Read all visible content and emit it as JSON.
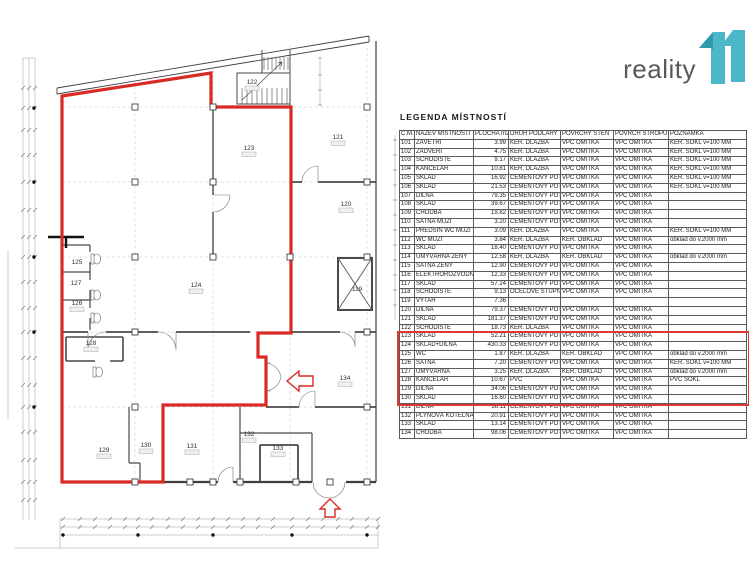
{
  "logo": {
    "text": "reality",
    "mark": "11",
    "teal": "#4bb7c8",
    "teal_dark": "#2e9aac",
    "text_color": "#58595b"
  },
  "legend": {
    "title": "LEGENDA MÍSTNOSTÍ",
    "columns": [
      "Č.M.",
      "NÁZEV MÍSTNOSTI",
      "PLOCHA m2",
      "DRUH PODLAHY",
      "POVRCHY STĚN",
      "POVRCH STROPU",
      "POZNÁMKA"
    ],
    "rows": [
      [
        "101",
        "ZÁVĚTŘÍ",
        "3.99",
        "KER. DLAŽBA",
        "VPC OMÍTKA",
        "VPC OMÍTKA",
        "KER. SOKL v=100 MM"
      ],
      [
        "102",
        "ZÁDVEŘÍ",
        "4.75",
        "KER. DLAŽBA",
        "VPC OMÍTKA",
        "VPC OMÍTKA",
        "KER. SOKL v=100 MM"
      ],
      [
        "103",
        "SCHODIŠTĚ",
        "9.17",
        "KER. DLAŽBA",
        "VPC OMÍTKA",
        "VPC OMÍTKA",
        "KER. SOKL v=100 MM"
      ],
      [
        "104",
        "KANCELÁŘ",
        "10.81",
        "KER. DLAŽBA",
        "VPC OMÍTKA",
        "VPC OMÍTKA",
        "KER. SOKL v=100 MM"
      ],
      [
        "105",
        "SKLAD",
        "16.92",
        "CEMENTOVÝ POTĚR",
        "VPC OMÍTKA",
        "VPC OMÍTKA",
        "KER. SOKL v=100 MM"
      ],
      [
        "106",
        "SKLAD",
        "21.53",
        "CEMENTOVÝ POTĚR",
        "VPC OMÍTKA",
        "VPC OMÍTKA",
        "KER. SOKL v=100 MM"
      ],
      [
        "107",
        "DÍLNA",
        "79.35",
        "CEMENTOVÝ POTĚR",
        "VPC OMÍTKA",
        "VPC OMÍTKA",
        ""
      ],
      [
        "108",
        "SKLAD",
        "39.67",
        "CEMENTOVÝ POTĚR",
        "VPC OMÍTKA",
        "VPC OMÍTKA",
        ""
      ],
      [
        "109",
        "CHODBA",
        "19.82",
        "CEMENTOVÝ POTĚR",
        "VPC OMÍTKA",
        "VPC OMÍTKA",
        ""
      ],
      [
        "110",
        "ŠATNA MUŽI",
        "3.20",
        "CEMENTOVÝ POTĚR",
        "VPC OMÍTKA",
        "VPC OMÍTKA",
        ""
      ],
      [
        "111",
        "PŘEDSÍŇ WC MUŽI",
        "3.09",
        "KER. DLAŽBA",
        "VPC OMÍTKA",
        "VPC OMÍTKA",
        "KER. SOKL v=100 MM"
      ],
      [
        "112",
        "WC MUŽI",
        "3.84",
        "KER. DLAŽBA",
        "KER. OBKLAD",
        "VPC OMÍTKA",
        "obklad do v.2000 mm"
      ],
      [
        "113",
        "SKLAD",
        "18.40",
        "CEMENTOVÝ POTĚR",
        "VPC OMÍTKA",
        "VPC OMÍTKA",
        ""
      ],
      [
        "114",
        "UMÝVÁRNA ŽENY",
        "12.58",
        "KER. DLAŽBA",
        "KER. OBKLAD",
        "VPC OMÍTKA",
        "obklad do v.2000 mm"
      ],
      [
        "115",
        "ŠATNA ŽENY",
        "12.90",
        "CEMENTOVÝ POTĚR",
        "VPC OMÍTKA",
        "VPC OMÍTKA",
        ""
      ],
      [
        "116",
        "ELEKTROROZVODNA",
        "12.33",
        "CEMENTOVÝ POTĚR",
        "VPC OMÍTKA",
        "VPC OMÍTKA",
        ""
      ],
      [
        "117",
        "SKLAD",
        "57.24",
        "CEMENTOVÝ POTĚR",
        "VPC OMÍTKA",
        "VPC OMÍTKA",
        ""
      ],
      [
        "118",
        "SCHODIŠTĚ",
        "9.13",
        "OCELOVÉ STUPNĚ",
        "VPC OMÍTKA",
        "VPC OMÍTKA",
        ""
      ],
      [
        "119",
        "VÝTAH",
        "7.36",
        "",
        "",
        "",
        ""
      ],
      [
        "120",
        "DÍLNA",
        "79.37",
        "CEMENTOVÝ POTĚR",
        "VPC OMÍTKA",
        "VPC OMÍTKA",
        ""
      ],
      [
        "121",
        "SKLAD",
        "181.37",
        "CEMENTOVÝ POTĚR",
        "VPC OMÍTKA",
        "VPC OMÍTKA",
        ""
      ],
      [
        "122",
        "SCHODIŠTĚ",
        "18.73",
        "KER. DLAŽBA",
        "VPC OMÍTKA",
        "VPC OMÍTKA",
        ""
      ],
      [
        "123",
        "SKLAD",
        "52.21",
        "CEMENTOVÝ POTĚR",
        "VPC OMÍTKA",
        "VPC OMÍTKA",
        ""
      ],
      [
        "124",
        "SKLAD+DÍLNA",
        "430.33",
        "CEMENTOVÝ POTĚR",
        "VPC OMÍTKA",
        "VPC OMÍTKA",
        ""
      ],
      [
        "125",
        "WC",
        "1.87",
        "KER. DLAŽBA",
        "KER. OBKLAD",
        "VPC OMÍTKA",
        "obklad do v.2000 mm"
      ],
      [
        "126",
        "ŠATNA",
        "7.20",
        "CEMENTOVÝ POTĚR",
        "VPC OMÍTKA",
        "VPC OMÍTKA",
        "KER. SOKL v=100 MM"
      ],
      [
        "127",
        "UMÝVÁRNA",
        "3.25",
        "KER. DLAŽBA",
        "KER. OBKLAD",
        "VPC OMÍTKA",
        "obklad do v.2000 mm"
      ],
      [
        "128",
        "KANCELÁŘ",
        "10.67",
        "PVC",
        "VPC OMÍTKA",
        "VPC OMÍTKA",
        "PVC SOKL"
      ],
      [
        "129",
        "DÍLNA",
        "34.06",
        "CEMENTOVÝ POTĚR",
        "VPC OMÍTKA",
        "VPC OMÍTKA",
        ""
      ],
      [
        "130",
        "SKLAD",
        "16.60",
        "CEMENTOVÝ POTĚR",
        "VPC OMÍTKA",
        "VPC OMÍTKA",
        ""
      ],
      [
        "131",
        "DÍLNA",
        "38.11",
        "CEMENTOVÝ POTĚR",
        "VPC OMÍTKA",
        "VPC OMÍTKA",
        ""
      ],
      [
        "132",
        "PLYNOVÁ KOTELNA",
        "20.91",
        "CEMENTOVÝ POTĚR",
        "VPC OMÍTKA",
        "VPC OMÍTKA",
        ""
      ],
      [
        "133",
        "SKLAD",
        "13.14",
        "CEMENTOVÝ POTĚR",
        "VPC OMÍTKA",
        "VPC OMÍTKA",
        ""
      ],
      [
        "134",
        "CHODBA",
        "98.06",
        "CEMENTOVÝ POTĚR",
        "VPC OMÍTKA",
        "VPC OMÍTKA",
        ""
      ]
    ],
    "highlight": {
      "from": "123",
      "to": "130",
      "color": "#e0372e"
    }
  },
  "floor_plan": {
    "highlight_color": "#da2a26",
    "rooms": [
      {
        "number": "119",
        "x": 357,
        "y": 291,
        "box": false
      },
      {
        "number": "120",
        "x": 346,
        "y": 206,
        "box": true
      },
      {
        "number": "121",
        "x": 338,
        "y": 139,
        "box": true
      },
      {
        "number": "122",
        "x": 252,
        "y": 84,
        "box": true
      },
      {
        "number": "123",
        "x": 249,
        "y": 150,
        "box": true
      },
      {
        "number": "124",
        "x": 196,
        "y": 287,
        "box": true
      },
      {
        "number": "125",
        "x": 77,
        "y": 264,
        "box": false
      },
      {
        "number": "127",
        "x": 76,
        "y": 285,
        "box": false
      },
      {
        "number": "126",
        "x": 77,
        "y": 305,
        "box": true
      },
      {
        "number": "128",
        "x": 91,
        "y": 345,
        "box": true
      },
      {
        "number": "129",
        "x": 104,
        "y": 452,
        "box": true
      },
      {
        "number": "130",
        "x": 146,
        "y": 447,
        "box": true
      },
      {
        "number": "131",
        "x": 192,
        "y": 448,
        "box": true
      },
      {
        "number": "132",
        "x": 249,
        "y": 436,
        "box": true
      },
      {
        "number": "133",
        "x": 278,
        "y": 450,
        "box": true
      },
      {
        "number": "134",
        "x": 345,
        "y": 380,
        "box": true
      }
    ]
  }
}
